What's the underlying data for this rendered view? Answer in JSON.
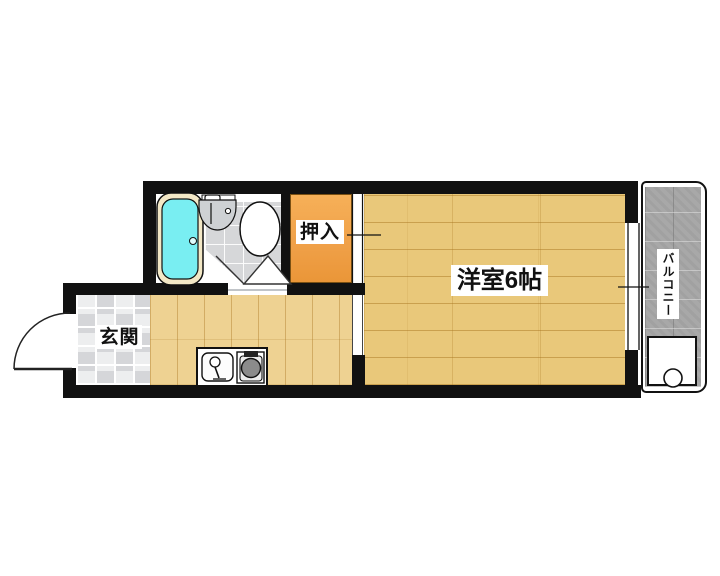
{
  "plan": {
    "labels": {
      "closet": "押入",
      "western_room": "洋室6帖",
      "balcony": "バルコニー",
      "entrance": "玄関"
    },
    "colors": {
      "wall": "#111111",
      "western_room_floor": "#e9c87a",
      "kitchen_floor": "#eed292",
      "closet_fill": "#f0a149",
      "balcony_tile": "#a8a8a8",
      "entrance_tile": "#d5d6d9",
      "toilet_floor_tile": "#d6d7d9",
      "bathtub_water": "#79eef2",
      "bathtub_rim": "#f3e8c6",
      "stove_burner": "#8b8b8b"
    },
    "fixtures": [
      "bathtub",
      "washbasin",
      "toilet",
      "folding-bathroom-door",
      "entry-door-swing",
      "sliding-closet-door",
      "balcony-window",
      "kitchen-sink",
      "gas-stove",
      "washing-machine-pan"
    ]
  }
}
